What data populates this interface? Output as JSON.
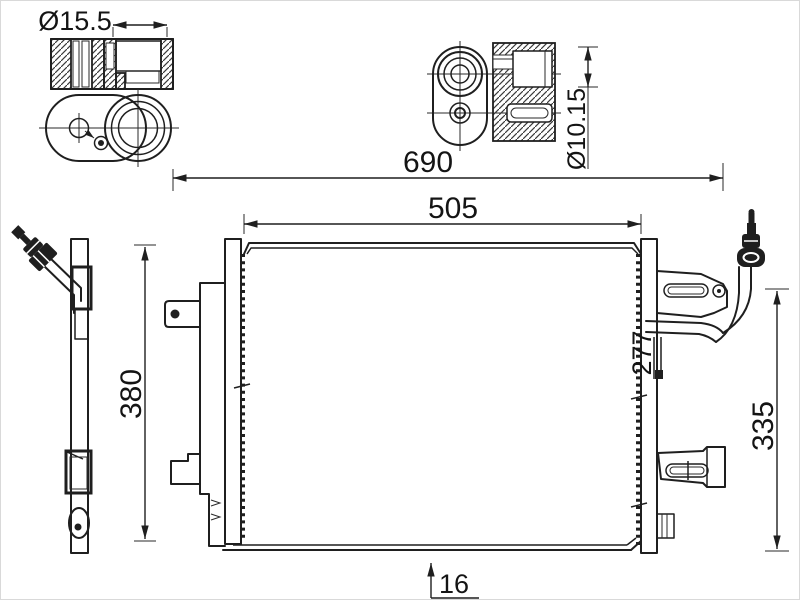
{
  "drawing": {
    "kind": "technical line drawing of an A/C condenser with receiver drier",
    "colors": {
      "line": "#1f1f1f",
      "background": "#ffffff"
    },
    "labels": {
      "dia_top_left": "Ø15.5",
      "dia_top_right": "Ø10.15",
      "overall_width": "690",
      "core_width": "505",
      "left_height": "380",
      "right_height": "335",
      "bracket_span": "277",
      "core_depth": "16"
    }
  }
}
